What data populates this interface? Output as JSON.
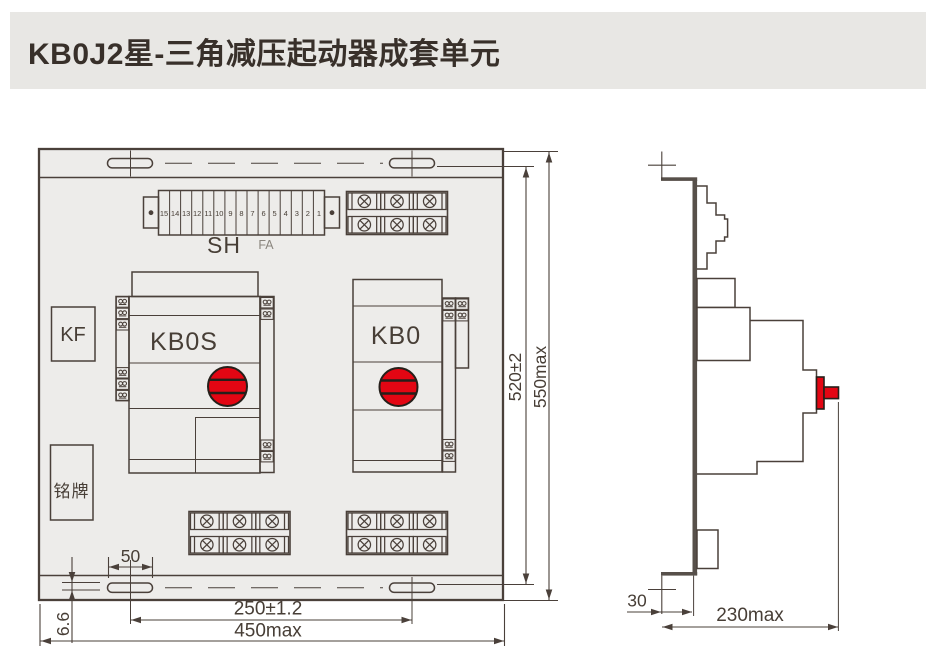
{
  "title": "KB0J2星-三角减压起动器成套单元",
  "front_view": {
    "strip_numbers": [
      "15",
      "14",
      "13",
      "12",
      "11",
      "10",
      "9",
      "8",
      "7",
      "6",
      "5",
      "4",
      "3",
      "2",
      "1"
    ],
    "strip_label": "SH",
    "strip_sublabel": "FA",
    "kf_label": "KF",
    "kbos_label": "KB0S",
    "kb0_label": "KB0",
    "nameplate_label": "铭牌",
    "dim_height_inner": "520±2",
    "dim_height_max": "550max",
    "dim_slot_width": "50",
    "dim_slot_height": "6.6",
    "dim_span": "250±1.2",
    "dim_width_max": "450max"
  },
  "side_view": {
    "dim_offset": "30",
    "dim_depth_max": "230max"
  },
  "colors": {
    "accent_red": "#e30613",
    "line": "#4a403a",
    "panel_fill": "#edecea",
    "titlebar_bg": "#e8e7e4"
  }
}
